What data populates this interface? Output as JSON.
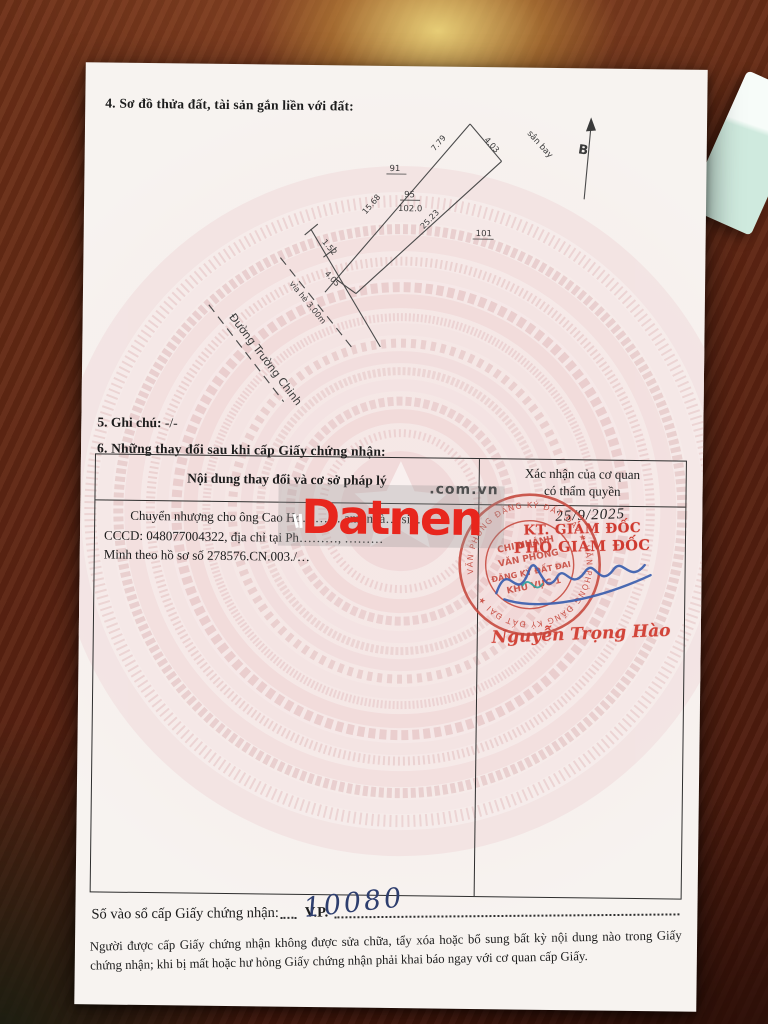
{
  "page": {
    "section4_title": "4. Sơ đồ thửa đất, tài sản gắn liền với đất:",
    "section5_label": "5. Ghi chú:",
    "section5_value": "-/-",
    "section6_title": "6. Những thay đổi sau khi cấp Giấy chứng nhận:"
  },
  "diagram": {
    "north_label": "B",
    "adjacent_top": "sân bay",
    "street_name": "Đường Trường Chinh",
    "sidewalk_label": "vỉa hè 3.00m",
    "edge_top_right": "4.03",
    "edge_nw_upper": "7.79",
    "edge_nw_lower": "15.68",
    "edge_se": "25.23",
    "edge_front": "4.05",
    "edge_front_jog": "1.52",
    "parcel_left": "91",
    "parcel_center": "95",
    "parcel_center_area": "102.0",
    "parcel_right": "101"
  },
  "table": {
    "col1_header": "Nội dung thay đổi và cơ sở pháp lý",
    "col2_header_line1": "Xác nhận của cơ quan",
    "col2_header_line2": "có thẩm quyền",
    "entry_line1": "Chuyển nhượng cho ông Cao Ho……… am, ngà… sin…",
    "entry_line2": "CCCD: 048077004322, địa chỉ tại Ph………, ………",
    "entry_line3": "Minh theo hồ sơ số 278576.CN.003./…",
    "confirm_date": "25/9/2025",
    "confirm_title1": "KT. GIÁM ĐỐC",
    "confirm_title2": "PHÓ GIÁM ĐỐC",
    "signer_name": "Nguyễn Trọng Hào",
    "seal_ring_text": "VĂN PHÒNG ĐĂNG KÝ ĐẤT ĐAI ★ VĂN PHÒNG ĐĂNG KÝ ĐẤT ĐAI ★",
    "seal_line1": "CHI NHÁNH",
    "seal_line2": "VĂN PHÒNG",
    "seal_line3": "ĐĂNG KÝ ĐẤT ĐAI",
    "seal_line4": "KHU VỰC 1"
  },
  "watermark": {
    "brand": "Datnen",
    "suffix": ".com.vn"
  },
  "footer": {
    "register_label": "Số vào sổ cấp Giấy chứng nhận:",
    "register_prefix": "V.P.",
    "register_number": "10080",
    "notice": "Người được cấp Giấy chứng nhận không được sửa chữa, tẩy xóa hoặc bổ sung bất kỳ nội dung nào trong Giấy chứng nhận; khi bị mất hoặc hư hỏng Giấy chứng nhận phải khai báo ngay với cơ quan cấp Giấy."
  },
  "colors": {
    "stamp_red": "#cf3a30",
    "watermark_red": "#e8261d",
    "signature_blue": "#3b5fae",
    "handwriting_blue": "#2e3e6e",
    "paper": "#f7f3f0",
    "guilloche_pink": "#e8caca",
    "wood_brown": "#5d2412"
  }
}
